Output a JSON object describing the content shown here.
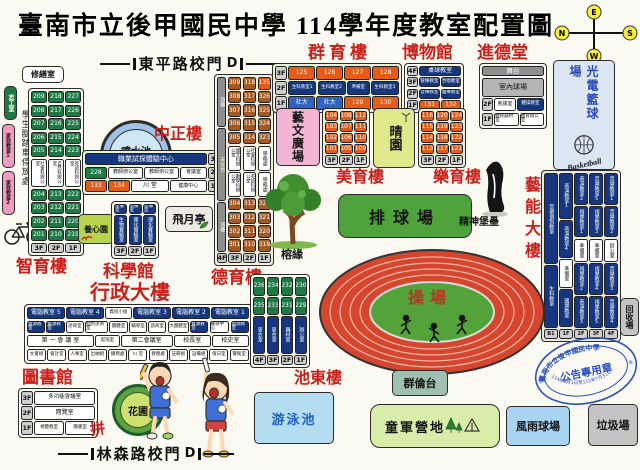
{
  "title": "臺南市立後甲國民中學 114學年度教室配置圖",
  "compass": {
    "top": "E",
    "left": "N",
    "right": "S",
    "bottom": "W"
  },
  "gate_top": {
    "label": "東平路校門",
    "d": "D"
  },
  "gate_bottom": {
    "label": "林森路校門",
    "d": "D"
  },
  "spirit": "拼",
  "left_wing": {
    "repair": "修繕室",
    "volunteer": "志工室",
    "home_ec1": "家政教室1",
    "home_ec2": "家政教室2",
    "bike": "學生腳踏車停放處"
  },
  "zhiyu": {
    "title": "智育樓",
    "col3f": [
      "209",
      "208",
      "207",
      "206",
      "205",
      {
        "t": "社會科辦公室",
        "c": "w v",
        "f": 2.4,
        "s": 4.5
      },
      "204",
      "203",
      "202",
      "201"
    ],
    "col2f": [
      "218",
      "217",
      "216",
      "215",
      "214",
      {
        "t": "自然科辦公室",
        "c": "w v",
        "f": 2.4,
        "s": 4.5
      },
      "213",
      "212",
      "211",
      "210"
    ],
    "col1f": [
      "227",
      "226",
      "225",
      "224",
      "223",
      {
        "t": "英語科辦公室",
        "c": "w v",
        "f": 2.4,
        "s": 4.5
      },
      "222",
      "221",
      "220",
      "219"
    ],
    "tags": [
      {
        "t": "3F",
        "c": "tag"
      },
      {
        "t": "2F",
        "c": "tag"
      },
      {
        "t": "1F",
        "c": "tag"
      }
    ]
  },
  "fountain": {
    "label": "噴水池"
  },
  "zhongzheng": {
    "title": "中正樓",
    "rows": [
      [
        {
          "t": "職業試探體驗中心",
          "c": "b",
          "f": 6,
          "s": 7
        },
        {
          "t": "3F",
          "c": "tag",
          "w": 14
        }
      ],
      [
        {
          "t": "228",
          "c": "g",
          "w": 22
        },
        {
          "t": "教師辦公室",
          "c": "w",
          "f": 2,
          "s": 5
        },
        {
          "t": "教師辦公室",
          "c": "w",
          "f": 2,
          "s": 5
        },
        {
          "t": "會議室",
          "c": "w",
          "f": 1.5,
          "s": 5
        },
        {
          "t": "2F",
          "c": "tag",
          "w": 14
        }
      ],
      [
        {
          "t": "133",
          "c": "o",
          "w": 22
        },
        {
          "t": "134",
          "c": "o",
          "w": 22
        },
        {
          "t": "川 堂",
          "c": "w",
          "f": 2,
          "s": 6
        },
        {
          "t": "健康中心",
          "c": "w",
          "f": 2,
          "s": 5
        },
        {
          "t": "1F",
          "c": "tag",
          "w": 14
        }
      ]
    ]
  },
  "yangxin": {
    "label": "養心園"
  },
  "science": {
    "title": "科學館",
    "cols": [
      [
        {
          "t": "準備室",
          "c": "b",
          "s": 4.5,
          "h": 10
        },
        {
          "t": "生物實驗室",
          "c": "b v",
          "f": 1,
          "s": 5
        }
      ],
      [
        {
          "t": "準備室",
          "c": "b",
          "s": 4.5,
          "h": 10
        },
        {
          "t": "理化實驗室",
          "c": "b v",
          "f": 1,
          "s": 5
        }
      ],
      [
        {
          "t": "準備室",
          "c": "b",
          "s": 4.5,
          "h": 10
        },
        {
          "t": "理化實驗室",
          "c": "b v",
          "f": 1,
          "s": 5
        }
      ]
    ],
    "tags": [
      {
        "t": "3F",
        "c": "tag"
      },
      {
        "t": "2F",
        "c": "tag"
      },
      {
        "t": "1F",
        "c": "tag"
      }
    ]
  },
  "feiyue": {
    "label": "飛月亭"
  },
  "deyu": {
    "title": "德育樓",
    "roof_col": [
      {
        "t": "頂樓",
        "c": "gy v",
        "f": 2,
        "s": 5
      },
      {
        "t": "天文台",
        "c": "gy v",
        "f": 3,
        "s": 5
      },
      {
        "t": "頂樓",
        "c": "gy v",
        "f": 2,
        "s": 5
      }
    ],
    "col3f": [
      "309",
      "308",
      "307",
      "306",
      "305",
      {
        "t": "國文科辦公室",
        "c": "w v",
        "f": 2,
        "s": 4.5
      },
      {
        "t": "數學科辦公室",
        "c": "w v",
        "f": 2,
        "s": 4.5
      },
      "304",
      "303",
      "302",
      "301"
    ],
    "col2f": [
      "318",
      "317",
      "316",
      "315",
      "314",
      {
        "t": "社會科辦公室",
        "c": "w v",
        "f": 2,
        "s": 4.5
      },
      {
        "t": "英語科辦公室",
        "c": "w v",
        "f": 2,
        "s": 4.5
      },
      "313",
      "312",
      "311",
      "310"
    ],
    "col1f": [
      {
        "t": "135",
        "c": "o"
      },
      "326",
      "325",
      "324",
      "323",
      {
        "t": "學務處",
        "c": "w v",
        "f": 2,
        "s": 5
      },
      {
        "t": "學務處",
        "c": "w v",
        "f": 2,
        "s": 5
      },
      "322",
      "321",
      "320",
      "319"
    ],
    "tags": [
      {
        "t": "4F",
        "c": "tag",
        "f": 0.7
      },
      {
        "t": "3F",
        "c": "tag"
      },
      {
        "t": "2F",
        "c": "tag"
      },
      {
        "t": "1F",
        "c": "tag"
      }
    ]
  },
  "admin": {
    "title": "行政大樓",
    "rows": [
      [
        {
          "t": "電腦教室 5",
          "c": "b"
        },
        {
          "t": "電腦教室 4",
          "c": "b"
        },
        {
          "t": "資訊小組",
          "c": "w",
          "f": 0.7,
          "s": 4.5
        },
        {
          "t": "電腦教室 3",
          "c": "b"
        },
        {
          "t": "電腦教室 2",
          "c": "b"
        },
        {
          "t": "電腦教室 1",
          "c": "b"
        },
        {
          "t": "4F",
          "c": "tag",
          "w": 13
        }
      ],
      [
        {
          "t": "資源教室",
          "c": "b"
        },
        {
          "t": "資源教室",
          "c": "b"
        },
        {
          "t": "諮商室",
          "c": "w"
        },
        {
          "t": "個別諮商室",
          "c": "w",
          "f": 1.3
        },
        {
          "t": "團體室",
          "c": "w"
        },
        {
          "t": "輔導室",
          "c": "w"
        },
        {
          "t": "諮商室",
          "c": "w"
        },
        {
          "t": "大團體室",
          "c": "w",
          "f": 1.2
        },
        {
          "t": "資源教室",
          "c": "b"
        },
        {
          "t": "輔導中心",
          "c": "w",
          "f": 1.1
        },
        {
          "t": "資源教室",
          "c": "b"
        },
        {
          "t": "3F",
          "c": "tag",
          "w": 13
        }
      ],
      [
        {
          "t": "第 一 會 議 室",
          "c": "w",
          "f": 2.6
        },
        {
          "t": "盥洗室",
          "c": "w",
          "f": 0.9,
          "s": 4.5
        },
        {
          "t": "第二會議室",
          "c": "w",
          "f": 2
        },
        {
          "t": "校長室",
          "c": "w",
          "f": 1.4
        },
        {
          "t": "校史室",
          "c": "w",
          "f": 1.4
        },
        {
          "t": "2F",
          "c": "tag",
          "w": 13
        }
      ],
      [
        "文書組",
        "會計室",
        "人事室",
        "出納組",
        "總務處",
        "川 堂",
        "教務處",
        "註冊組",
        "設備組",
        "值日室",
        "警衛室",
        {
          "t": "1F",
          "c": "tag",
          "w": 13
        }
      ]
    ]
  },
  "library": {
    "title": "圖書館",
    "rows": [
      [
        {
          "t": "3F",
          "c": "tag",
          "w": 12
        },
        {
          "t": "多功能會議室",
          "c": "w",
          "s": 5.5
        }
      ],
      [
        {
          "t": "2F",
          "c": "tag",
          "w": 12
        },
        {
          "t": "閱覽室",
          "c": "w",
          "s": 6
        }
      ],
      [
        {
          "t": "1F",
          "c": "tag",
          "w": 12
        },
        {
          "t": "視聽教室",
          "c": "w",
          "s": 4.5
        },
        {
          "t": "圖書室",
          "c": "w",
          "s": 4.5
        }
      ]
    ]
  },
  "garden": {
    "label": "花圃"
  },
  "chidong": {
    "title": "池東樓",
    "cols": [
      [
        "236",
        "235",
        {
          "t": "更衣室",
          "c": "b v",
          "f": 2,
          "s": 5
        }
      ],
      [
        "234",
        "233",
        {
          "t": "更衣室",
          "c": "b v",
          "f": 2,
          "s": 5
        }
      ],
      [
        "232",
        "231",
        {
          "t": "器材室",
          "c": "b v",
          "f": 2,
          "s": 5
        }
      ],
      [
        "230",
        "229",
        {
          "t": "辦公室",
          "c": "b v",
          "f": 2,
          "s": 5
        }
      ]
    ],
    "tags": [
      {
        "t": "4F",
        "c": "tag"
      },
      {
        "t": "3F",
        "c": "tag"
      },
      {
        "t": "2F",
        "c": "tag"
      },
      {
        "t": "1F",
        "c": "tag"
      }
    ]
  },
  "pool": {
    "label": "游泳池"
  },
  "track": {
    "label": "操場"
  },
  "qunlun": {
    "label": "群倫台"
  },
  "scout": {
    "label": "童軍營地"
  },
  "rain": {
    "label": "風雨球場"
  },
  "trash": {
    "label": "垃圾場"
  },
  "recycle": {
    "label": "回收場"
  },
  "stamp": {
    "school": "臺南市立後甲國民中學",
    "center": "公告專用章",
    "date": "114年8月1日至115年7月31日",
    "mark": "※"
  },
  "qunyu": {
    "title": "群育樓",
    "rows": [
      [
        {
          "t": "3F",
          "c": "tag",
          "w": 12
        },
        {
          "t": "125",
          "c": "o"
        },
        {
          "t": "126",
          "c": "o"
        },
        {
          "t": "127",
          "c": "o"
        },
        {
          "t": "128",
          "c": "o"
        }
      ],
      [
        {
          "t": "2F",
          "c": "tag",
          "w": 12
        },
        {
          "t": "生科教室1",
          "c": "b",
          "s": 4.5
        },
        {
          "t": "生科教室2",
          "c": "b",
          "s": 4.5
        },
        {
          "t": "準備室",
          "c": "b",
          "s": 4.5,
          "f": 0.8
        },
        {
          "t": "生科教室3",
          "c": "b",
          "s": 4.5
        }
      ],
      [
        {
          "t": "1F",
          "c": "tag",
          "w": 12
        },
        {
          "t": "社大",
          "c": "lb"
        },
        {
          "t": "社大",
          "c": "lb"
        },
        {
          "t": "129",
          "c": "o"
        },
        {
          "t": "130",
          "c": "o"
        }
      ]
    ]
  },
  "museum": {
    "title": "博物館",
    "rows": [
      [
        {
          "t": "4F",
          "c": "tag",
          "w": 11
        },
        {
          "t": "桌球教室",
          "c": "b",
          "s": 6
        }
      ],
      [
        {
          "t": "3F",
          "c": "tag",
          "w": 11
        },
        {
          "t": "管樂教室",
          "c": "b",
          "s": 4.5
        },
        {
          "t": "合唱教室",
          "c": "b",
          "s": 4.5
        }
      ],
      [
        {
          "t": "2F",
          "c": "tag",
          "w": 11
        },
        {
          "t": "音樂教室",
          "c": "b",
          "s": 4.5
        },
        {
          "t": "國樂教室",
          "c": "b",
          "s": 4.5
        }
      ],
      [
        {
          "t": "1F",
          "c": "tag",
          "w": 11
        },
        {
          "t": "131",
          "c": "o"
        },
        {
          "t": "132",
          "c": "o"
        }
      ]
    ]
  },
  "jinde": {
    "title": "進德堂",
    "stage": "舞台",
    "court": "室內球場",
    "rows": [
      [
        {
          "t": "2F",
          "c": "tag",
          "w": 11
        },
        {
          "t": "會議室",
          "c": "w",
          "s": 5
        },
        {
          "t": "體操教室",
          "c": "b",
          "s": 4.5,
          "f": 1.3
        }
      ],
      [
        {
          "t": "1F",
          "c": "tag",
          "w": 11
        },
        {
          "t": "體育器材室",
          "c": "w",
          "s": 4.5
        },
        {
          "t": "體育辦公室",
          "c": "w",
          "s": 4.5
        }
      ]
    ]
  },
  "photon": {
    "title": "光電籃球場",
    "script": "Basketball"
  },
  "yineng": {
    "title": "藝能大樓",
    "cols": [
      [
        {
          "t": "音樂個別教室",
          "f": 3
        },
        {
          "t": "生科教室",
          "f": 2
        }
      ],
      [
        {
          "t": "表演教室1",
          "f": 1.2
        },
        {
          "t": "表演教室4"
        },
        {
          "t": "準備室",
          "c": "w v",
          "f": 0.7
        },
        {
          "t": "國樂教室"
        }
      ],
      [
        {
          "t": "表演教室2"
        },
        {
          "t": "視覺教室1"
        },
        {
          "t": "準備室",
          "c": "w v",
          "f": 0.7
        },
        {
          "t": "視覺教室2"
        },
        {
          "t": "表演教室3"
        }
      ],
      [
        {
          "t": "音樂教室5"
        },
        {
          "t": "視覺教室3"
        },
        {
          "t": "準備室",
          "c": "w v",
          "f": 0.7
        },
        {
          "t": "視覺教室4"
        },
        {
          "t": "視覺教室5"
        }
      ],
      [
        {
          "t": "音樂教室1"
        },
        {
          "t": "音樂教室2"
        },
        {
          "t": "辦公室",
          "c": "w v",
          "f": 0.7
        },
        {
          "t": "音樂教室3"
        },
        {
          "t": "音樂教室4"
        }
      ]
    ],
    "tags": [
      {
        "t": "B1",
        "c": "tag"
      },
      {
        "t": "1F",
        "c": "tag"
      },
      {
        "t": "2F",
        "c": "tag"
      },
      {
        "t": "3F",
        "c": "tag"
      },
      {
        "t": "4F",
        "c": "tag"
      }
    ]
  },
  "yiwen": {
    "label": "藝文廣場"
  },
  "qingyuan": {
    "label": "晴園"
  },
  "meiyu": {
    "title": "美育樓",
    "cols": [
      [
        "104",
        "103",
        "102",
        "101"
      ],
      [
        "108",
        "107",
        "106",
        "105"
      ],
      [
        "112",
        "111",
        "110",
        "109"
      ]
    ],
    "tags": [
      {
        "t": "3F",
        "c": "tag"
      },
      {
        "t": "2F",
        "c": "tag"
      },
      {
        "t": "1F",
        "c": "tag"
      }
    ]
  },
  "leyu": {
    "title": "樂育樓",
    "cols": [
      [
        "116",
        "115",
        "114",
        "113"
      ],
      [
        "120",
        "119",
        "118",
        "117"
      ],
      [
        "124",
        "123",
        "122",
        "121"
      ]
    ],
    "tags": [
      {
        "t": "3F",
        "c": "tag"
      },
      {
        "t": "2F",
        "c": "tag"
      },
      {
        "t": "1F",
        "c": "tag"
      }
    ]
  },
  "volleyball": {
    "label": "排球場"
  },
  "banyan": {
    "label": "榕緣"
  },
  "monument": {
    "label": "精神堡壘"
  }
}
